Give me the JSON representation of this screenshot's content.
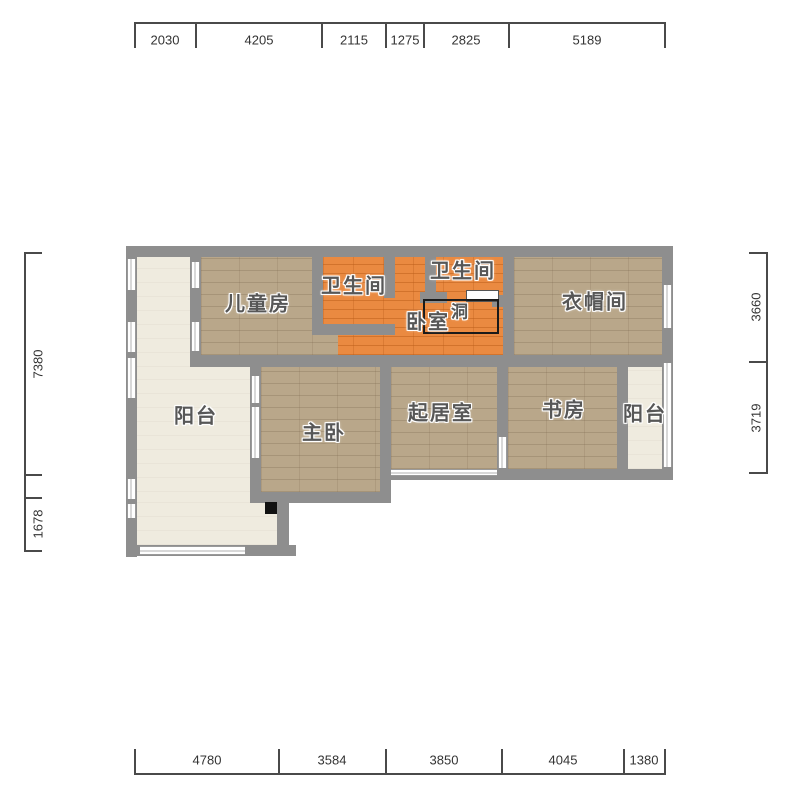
{
  "title": "apartment-floorplan",
  "dimensions": {
    "top": [
      "2030",
      "4205",
      "2115",
      "1275",
      "2825",
      "5189"
    ],
    "bottom": [
      "4780",
      "3584",
      "3850",
      "4045",
      "1380"
    ],
    "left": [
      "7380",
      "1678"
    ],
    "right": [
      "3660",
      "3719"
    ]
  },
  "rooms": {
    "children": {
      "label": "儿童房"
    },
    "bath1": {
      "label": "卫生间"
    },
    "bath2": {
      "label": "卫生间"
    },
    "bedroom": {
      "label": "卧室"
    },
    "hole": {
      "label": "洞"
    },
    "cloakroom": {
      "label": "衣帽间"
    },
    "balcony_left": {
      "label": "阳台"
    },
    "master": {
      "label": "主卧"
    },
    "living": {
      "label": "起居室"
    },
    "study": {
      "label": "书房"
    },
    "balcony_right": {
      "label": "阳台"
    }
  },
  "colors": {
    "wall": "#8e8e8e",
    "wood_floor": "#b9a78a",
    "orange_floor": "#ea8a41",
    "balcony_floor": "#efebdf",
    "hole_outline": "#1a1a1a",
    "dimension_text": "#333333",
    "room_label_text": "#575757"
  }
}
